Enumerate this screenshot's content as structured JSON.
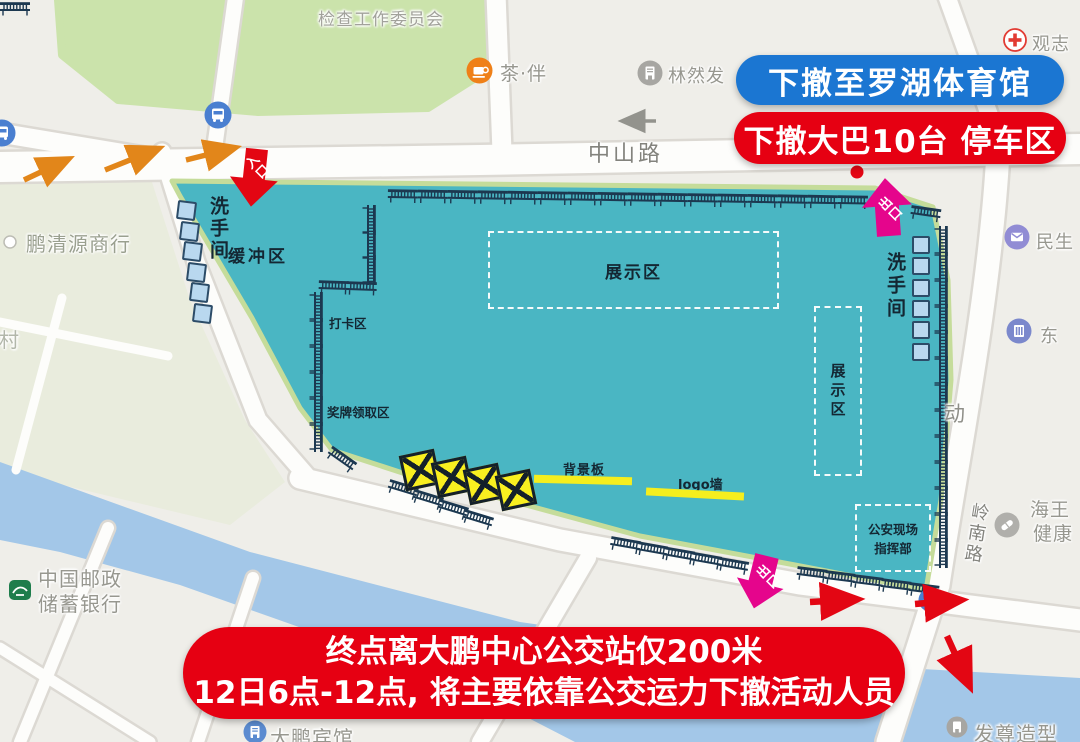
{
  "banners": {
    "evacuate_destination": "下撤至罗湖体育馆",
    "bus_parking": "下撤大巴10台 停车区",
    "bottom_notice_line1": "终点离大鹏中心公交站仅200米",
    "bottom_notice_line2": "12日6点-12点, 将主要依靠公交运力下撤活动人员"
  },
  "venue_zones": {
    "buffer_zone": "缓冲区",
    "restroom_left": "洗手间",
    "restroom_right": "洗手间",
    "checkin_zone": "打卡区",
    "medal_zone": "奖牌领取区",
    "exhibit_center": "展示区",
    "exhibit_right": "展示区",
    "backdrop_board": "背景板",
    "logo_wall": "logo墙",
    "police_command_line1": "公安现场",
    "police_command_line2": "指挥部",
    "entrance": "入口",
    "exit_top": "出口",
    "exit_bottom": "出口"
  },
  "map_labels": {
    "committee": "检查工作委员会",
    "tea_house": "茶·伴",
    "linranfa": "林然发",
    "guanzhi": "观志",
    "xincun": "新村",
    "pengqingyuan_store": "鹏清源商行",
    "zhongshan_road": "中山路",
    "minsheng": "民生",
    "dong_poi": "东",
    "dong_char": "动",
    "lingnan_road": "岭南路",
    "haiwang_line1": "海王",
    "haiwang_line2": "健康",
    "post_bank_line1": "中国邮政",
    "post_bank_line2": "储蓄银行",
    "dapeng_hotel": "大鹏宾馆",
    "hair_salon": "发尊造型"
  },
  "colors": {
    "venue_fill": "#4ab6c3",
    "venue_edge_green": "#c5dc9a",
    "banner_blue": "#1b76d2",
    "banner_red": "#e60012",
    "exit_magenta": "#e5058c",
    "route_orange": "#e2861a",
    "highlight_yellow": "#f8ef20",
    "water": "#a3c7e8",
    "park_green": "#cbe3ab",
    "barrier_navy": "#1c3850"
  }
}
